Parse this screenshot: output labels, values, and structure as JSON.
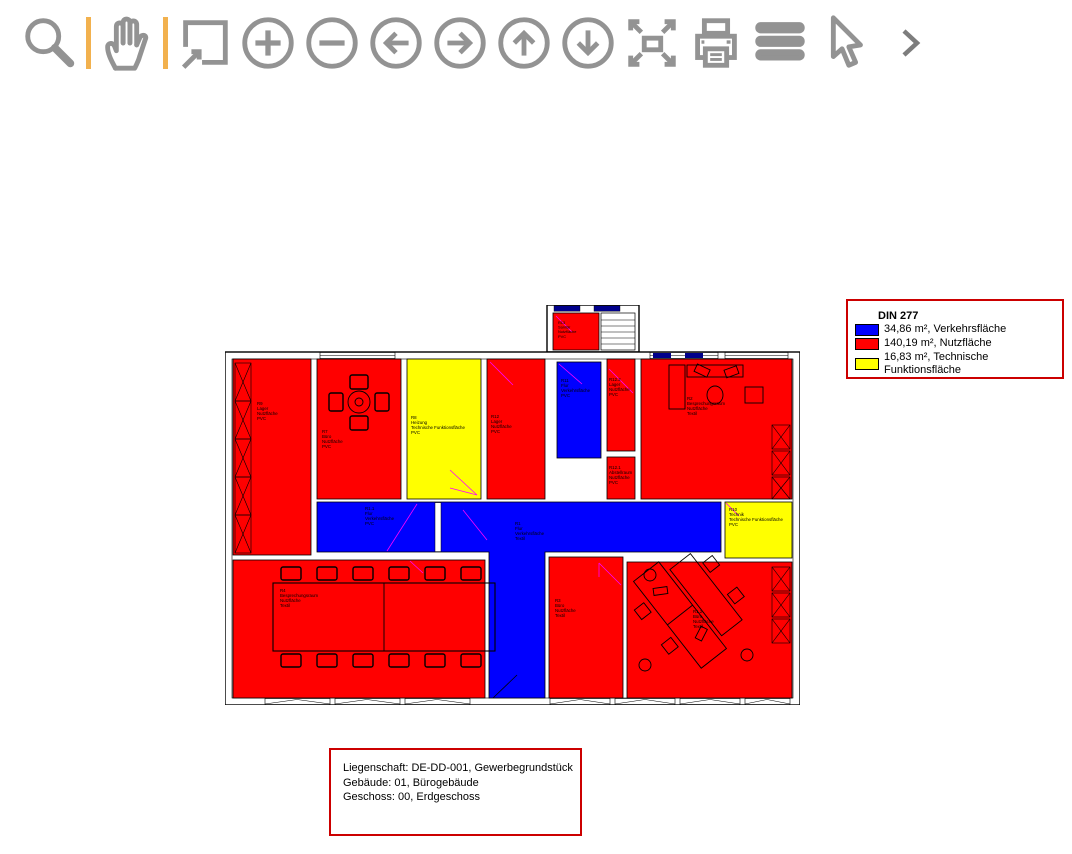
{
  "toolbar": {
    "separator_color": "#F2B14E",
    "icon_color": "#939393",
    "tools": [
      {
        "name": "zoom-select",
        "icon": "magnifier-icon"
      },
      {
        "name": "pan",
        "icon": "hand-icon"
      },
      {
        "name": "zoom-window",
        "icon": "window-arrow-icon"
      },
      {
        "name": "zoom-in",
        "icon": "circle-plus-icon"
      },
      {
        "name": "zoom-out",
        "icon": "circle-minus-icon"
      },
      {
        "name": "pan-left",
        "icon": "circle-arrow-left-icon"
      },
      {
        "name": "pan-right",
        "icon": "circle-arrow-right-icon"
      },
      {
        "name": "pan-up",
        "icon": "circle-arrow-up-icon"
      },
      {
        "name": "pan-down",
        "icon": "circle-arrow-down-icon"
      },
      {
        "name": "zoom-extents",
        "icon": "expand-arrows-icon"
      },
      {
        "name": "print",
        "icon": "printer-icon"
      },
      {
        "name": "layers",
        "icon": "horizontal-bars-icon"
      },
      {
        "name": "select",
        "icon": "cursor-arrow-icon"
      },
      {
        "name": "more-tools",
        "icon": "chevron-right-icon"
      }
    ]
  },
  "legend": {
    "border_color": "#CC0000",
    "title": "DIN 277",
    "entries": [
      {
        "color": "#0000FF",
        "label": "34,86 m², Verkehrsfläche"
      },
      {
        "color": "#FF0000",
        "label": "140,19 m², Nutzfläche"
      },
      {
        "color": "#FFFF00",
        "label": "16,83 m², Technische Funktionsfläche"
      }
    ]
  },
  "info_box": {
    "border_color": "#CC0000",
    "lines": [
      "Liegenschaft: DE-DD-001, Gewerbegrundstück",
      "Gebäude: 01, Bürogebäude",
      "Geschoss: 00, Erdgeschoss"
    ]
  },
  "plan": {
    "colors": {
      "nutzflaeche": "#FF0000",
      "verkehrsflaeche": "#0000FF",
      "technische_funktionsflaeche": "#FFFF00",
      "window_dark": "#00008B",
      "door_marker": "#FF00FF"
    },
    "rooms": [
      {
        "id": "R9",
        "name": "Lager",
        "area_type": "Nutzfläche",
        "covering": "PVC"
      },
      {
        "id": "R7",
        "name": "Büro",
        "area_type": "Nutzfläche",
        "covering": "PVC"
      },
      {
        "id": "R8",
        "name": "Heizung",
        "area_type": "Technische Funktionsfläche",
        "covering": "PVC"
      },
      {
        "id": "R12",
        "name": "Lager",
        "area_type": "Nutzfläche",
        "covering": "PVC"
      },
      {
        "id": "R13",
        "name": "Sanitär",
        "area_type": "Nutzfläche",
        "covering": "PVC"
      },
      {
        "id": "R11",
        "name": "Flur",
        "area_type": "Verkehrsfläche",
        "covering": "PVC"
      },
      {
        "id": "R12.2",
        "name": "Lager",
        "area_type": "Nutzfläche",
        "covering": "PVC"
      },
      {
        "id": "R12.1",
        "name": "Abstellraum",
        "area_type": "Nutzfläche",
        "covering": "PVC"
      },
      {
        "id": "R2",
        "name": "Besprechungsraum",
        "area_type": "Nutzfläche",
        "covering": "Textil"
      },
      {
        "id": "R1.1",
        "name": "Flur",
        "area_type": "Verkehrsfläche",
        "covering": "PVC"
      },
      {
        "id": "R1",
        "name": "Flur",
        "area_type": "Verkehrsfläche",
        "covering": "Textil"
      },
      {
        "id": "R10",
        "name": "Technik",
        "area_type": "Technische Funktionsfläche",
        "covering": "PVC"
      },
      {
        "id": "R4",
        "name": "Besprechungsraum",
        "area_type": "Nutzfläche",
        "covering": "Textil"
      },
      {
        "id": "R3",
        "name": "Büro",
        "area_type": "Nutzfläche",
        "covering": "Textil"
      },
      {
        "id": "R1.2",
        "name": "Büro",
        "area_type": "Nutzfläche",
        "covering": "Textil"
      }
    ]
  }
}
